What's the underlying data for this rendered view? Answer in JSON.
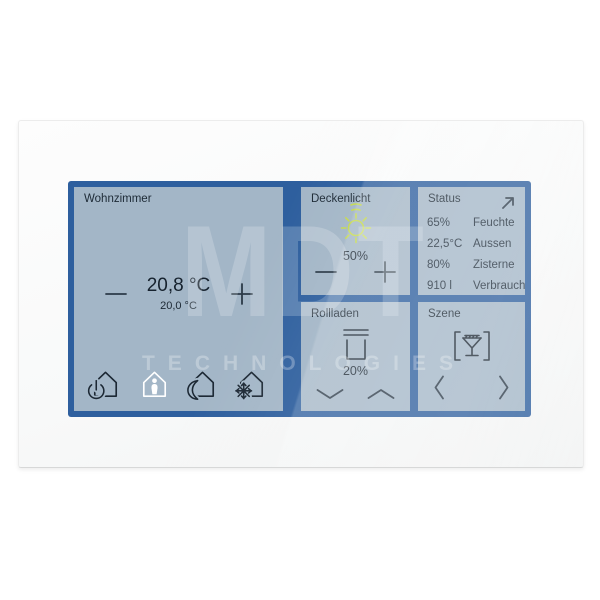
{
  "brand_watermark": {
    "title": "MDT",
    "subtitle": "TECHNOLOGIES"
  },
  "colors": {
    "frame_blue": "#2e5f9e",
    "tile_background": "#a3b6c7",
    "text_dark": "#1c2834",
    "sun_yellow_green": "#c4d94e",
    "active_mode_white": "#ffffff"
  },
  "tiles": {
    "room": {
      "title": "Wohnzimmer",
      "current_temp": "20,8 °C",
      "setpoint_temp": "20,0 °C",
      "decrease_label": "−",
      "increase_label": "+",
      "modes": [
        {
          "name": "standby",
          "active": false
        },
        {
          "name": "presence",
          "active": true
        },
        {
          "name": "night",
          "active": false
        },
        {
          "name": "frost-protection",
          "active": false
        }
      ]
    },
    "ceiling_light": {
      "title": "Deckenlicht",
      "level": "50%",
      "decrease_label": "−",
      "increase_label": "+"
    },
    "status": {
      "title": "Status",
      "expand_label": "Status öffnen",
      "rows": [
        {
          "value": "65%",
          "label": "Feuchte"
        },
        {
          "value": "22,5°C",
          "label": "Aussen"
        },
        {
          "value": "80%",
          "label": "Zisterne"
        },
        {
          "value": "910 l",
          "label": "Verbrauch"
        }
      ]
    },
    "shutter": {
      "title": "Rollladen",
      "level": "20%",
      "down_label": "ab",
      "up_label": "auf"
    },
    "scene": {
      "title": "Szene",
      "previous_label": "zurück",
      "next_label": "weiter"
    }
  },
  "icons": {
    "standby": "power-house-icon",
    "presence": "presence-house-icon",
    "night": "night-house-icon",
    "frost": "frost-house-icon",
    "light": "sun-brightness-icon",
    "shutter": "roller-shutter-icon",
    "scene": "scene-cocktail-icon",
    "status": "expand-arrow-icon"
  }
}
